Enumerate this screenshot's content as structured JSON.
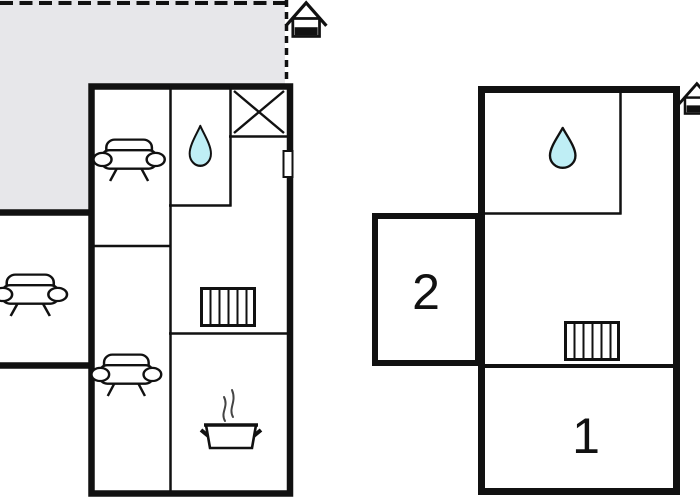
{
  "colors": {
    "background": "#ffffff",
    "wall": "#111111",
    "terrace_fill": "#e7e7ea",
    "water_drop_fill": "#bfeef5",
    "steam": "#444444"
  },
  "floorplan": {
    "outdoor": {
      "icons": [
        {
          "name": "house-entrance-icon"
        },
        {
          "name": "sofa-icon"
        }
      ]
    },
    "building_left": {
      "icons": [
        {
          "name": "sofa-icon"
        },
        {
          "name": "water-drop-icon"
        },
        {
          "name": "crossed-box-icon"
        },
        {
          "name": "door-marker"
        },
        {
          "name": "radiator-icon"
        },
        {
          "name": "sofa-icon"
        },
        {
          "name": "cooking-pot-icon"
        }
      ]
    },
    "building_right": {
      "rooms": [
        {
          "label": "1"
        },
        {
          "label": "2"
        }
      ],
      "icons": [
        {
          "name": "water-drop-icon"
        },
        {
          "name": "radiator-icon"
        },
        {
          "name": "house-entrance-icon"
        }
      ]
    }
  }
}
